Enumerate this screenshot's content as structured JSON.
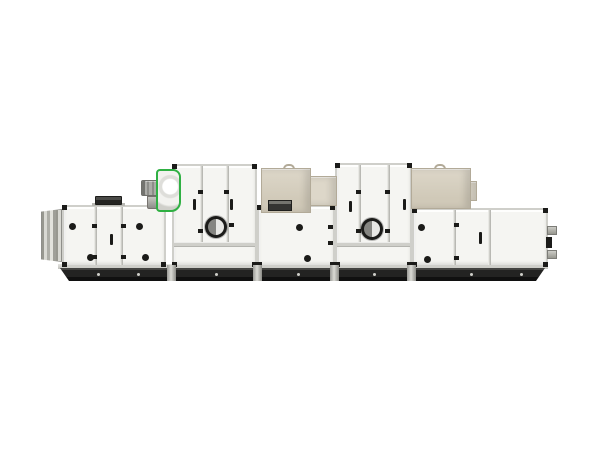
{
  "scene": {
    "type": "product-photo",
    "subject": "modular-air-handling-unit-side-view",
    "background": "#ffffff"
  },
  "colors": {
    "background": "#ffffff",
    "panel": "#f5f5f2",
    "frame": "#cfcfca",
    "dark": "#1b1b19",
    "green": "#2fb043",
    "beige": "#d0c9b8",
    "beigeLight": "#ddd7c9",
    "beigeEdge": "#b2aa98",
    "base": "#232322"
  },
  "machine": {
    "sections": [
      {
        "name": "inlet-louver"
      },
      {
        "name": "intake-section-with-doors"
      },
      {
        "name": "fan-assembly-green-housing"
      },
      {
        "name": "tall-filter-section-1-with-porthole"
      },
      {
        "name": "mid-section-with-coil-box"
      },
      {
        "name": "tall-filter-section-2-with-porthole"
      },
      {
        "name": "end-section-with-coil-box-and-pipe-stubs"
      }
    ],
    "counts": {
      "portholes": 2,
      "coil_boxes": 2,
      "door_knobs": 10,
      "door_handles": 6,
      "base_feet": 4
    }
  }
}
